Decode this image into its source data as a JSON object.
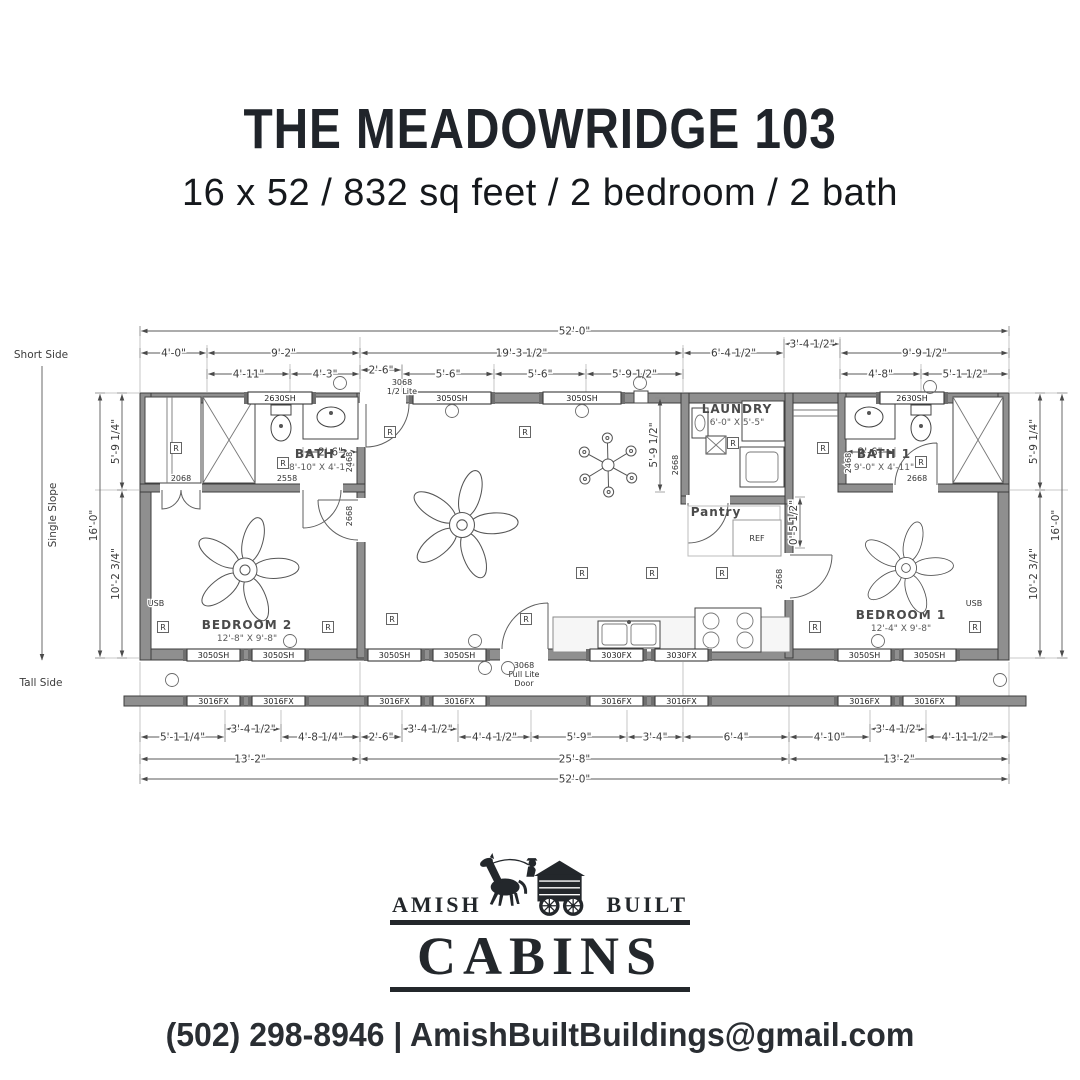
{
  "header": {
    "title": "THE MEADOWRIDGE 103",
    "subtitle": "16 x 52 / 832 sq feet / 2 bedroom / 2 bath"
  },
  "colors": {
    "ink": "#23272b",
    "plan_line": "#4a4a4a",
    "wall_fill": "#8f8f8f"
  },
  "plan": {
    "side": {
      "short": "Short Side",
      "slope": "Single Slope",
      "tall": "Tall Side"
    },
    "receptacle_letter": "R",
    "rooms": [
      {
        "name": "BATH 2",
        "size": "8'-10\" X 4'-11\"",
        "x": 322,
        "y": 458
      },
      {
        "name": "LAUNDRY",
        "size": "6'-0\" X 5'-5\"",
        "x": 737,
        "y": 413
      },
      {
        "name": "BATH 1",
        "size": "9'-0\" X 4'-11\"",
        "x": 884,
        "y": 458
      },
      {
        "name": "Pantry",
        "size": "",
        "x": 716,
        "y": 516
      },
      {
        "name": "BEDROOM 2",
        "size": "12'-8\" X 9'-8\"",
        "x": 247,
        "y": 629
      },
      {
        "name": "BEDROOM 1",
        "size": "12'-4\" X 9'-8\"",
        "x": 901,
        "y": 619
      }
    ],
    "dims_h": [
      {
        "t": "52'-0\"",
        "x1": 140,
        "x2": 1009,
        "y": 331
      },
      {
        "t": "4'-0\"",
        "x1": 140,
        "x2": 207,
        "y": 353
      },
      {
        "t": "9'-2\"",
        "x1": 207,
        "x2": 360,
        "y": 353
      },
      {
        "t": "19'-3 1/2\"",
        "x1": 360,
        "x2": 683,
        "y": 353
      },
      {
        "t": "6'-4 1/2\"",
        "x1": 683,
        "x2": 784,
        "y": 353
      },
      {
        "t": "3'-4 1/2\"",
        "x1": 784,
        "x2": 840,
        "y": 344
      },
      {
        "t": "9'-9 1/2\"",
        "x1": 840,
        "x2": 1009,
        "y": 353
      },
      {
        "t": "4'-11\"",
        "x1": 207,
        "x2": 290,
        "y": 374
      },
      {
        "t": "4'-3\"",
        "x1": 290,
        "x2": 360,
        "y": 374
      },
      {
        "t": "2'-6\"",
        "x1": 360,
        "x2": 402,
        "y": 370
      },
      {
        "t": "5'-6\"",
        "x1": 402,
        "x2": 494,
        "y": 374
      },
      {
        "t": "5'-6\"",
        "x1": 494,
        "x2": 586,
        "y": 374
      },
      {
        "t": "5'-9 1/2\"",
        "x1": 586,
        "x2": 683,
        "y": 374
      },
      {
        "t": "4'-8\"",
        "x1": 840,
        "x2": 921,
        "y": 374
      },
      {
        "t": "5'-1 1/2\"",
        "x1": 921,
        "x2": 1009,
        "y": 374
      },
      {
        "t": "2'-6\"",
        "x1": 303,
        "x2": 358,
        "y": 452
      },
      {
        "t": "2'-6\"",
        "x1": 845,
        "x2": 895,
        "y": 452
      },
      {
        "t": "5'-1 1/4\"",
        "x1": 140,
        "x2": 225,
        "y": 737
      },
      {
        "t": "3'-4 1/2\"",
        "x1": 225,
        "x2": 281,
        "y": 729
      },
      {
        "t": "4'-8 1/4\"",
        "x1": 281,
        "x2": 360,
        "y": 737
      },
      {
        "t": "2'-6\"",
        "x1": 360,
        "x2": 402,
        "y": 737
      },
      {
        "t": "3'-4 1/2\"",
        "x1": 402,
        "x2": 458,
        "y": 729
      },
      {
        "t": "4'-4 1/2\"",
        "x1": 458,
        "x2": 531,
        "y": 737
      },
      {
        "t": "5'-9\"",
        "x1": 531,
        "x2": 627,
        "y": 737
      },
      {
        "t": "3'-4\"",
        "x1": 627,
        "x2": 683,
        "y": 737
      },
      {
        "t": "6'-4\"",
        "x1": 683,
        "x2": 789,
        "y": 737
      },
      {
        "t": "4'-10\"",
        "x1": 789,
        "x2": 870,
        "y": 737
      },
      {
        "t": "3'-4 1/2\"",
        "x1": 870,
        "x2": 926,
        "y": 729
      },
      {
        "t": "4'-11 1/2\"",
        "x1": 926,
        "x2": 1009,
        "y": 737
      },
      {
        "t": "13'-2\"",
        "x1": 140,
        "x2": 360,
        "y": 759
      },
      {
        "t": "25'-8\"",
        "x1": 360,
        "x2": 789,
        "y": 759
      },
      {
        "t": "13'-2\"",
        "x1": 789,
        "x2": 1009,
        "y": 759
      },
      {
        "t": "52'-0\"",
        "x1": 140,
        "x2": 1009,
        "y": 779
      }
    ],
    "dims_v": [
      {
        "t": "16'-0\"",
        "x": 100,
        "y1": 393,
        "y2": 658
      },
      {
        "t": "5'-9 1/4\"",
        "x": 122,
        "y1": 393,
        "y2": 490
      },
      {
        "t": "10'-2 3/4\"",
        "x": 122,
        "y1": 490,
        "y2": 658
      },
      {
        "t": "5'-9 1/4\"",
        "x": 1040,
        "y1": 393,
        "y2": 490
      },
      {
        "t": "10'-2 3/4\"",
        "x": 1040,
        "y1": 490,
        "y2": 658
      },
      {
        "t": "16'-0\"",
        "x": 1062,
        "y1": 393,
        "y2": 658
      },
      {
        "t": "5'-9 1/2\"",
        "x": 660,
        "y1": 398,
        "y2": 492
      },
      {
        "t": "0'-5 1/2\"",
        "x": 800,
        "y1": 497,
        "y2": 548
      }
    ],
    "windows": [
      {
        "t": "2630SH",
        "x": 248,
        "y": 392,
        "w": 64,
        "h": 12
      },
      {
        "t": "3050SH",
        "x": 413,
        "y": 392,
        "w": 78,
        "h": 12
      },
      {
        "t": "3050SH",
        "x": 543,
        "y": 392,
        "w": 78,
        "h": 12
      },
      {
        "t": "2630SH",
        "x": 880,
        "y": 392,
        "w": 64,
        "h": 12
      },
      {
        "t": "3050SH",
        "x": 187,
        "y": 649,
        "w": 53,
        "h": 12
      },
      {
        "t": "3050SH",
        "x": 252,
        "y": 649,
        "w": 53,
        "h": 12
      },
      {
        "t": "3050SH",
        "x": 368,
        "y": 649,
        "w": 53,
        "h": 12
      },
      {
        "t": "3050SH",
        "x": 433,
        "y": 649,
        "w": 53,
        "h": 12
      },
      {
        "t": "3030FX",
        "x": 590,
        "y": 649,
        "w": 53,
        "h": 12
      },
      {
        "t": "3030FX",
        "x": 655,
        "y": 649,
        "w": 53,
        "h": 12
      },
      {
        "t": "3050SH",
        "x": 838,
        "y": 649,
        "w": 53,
        "h": 12
      },
      {
        "t": "3050SH",
        "x": 903,
        "y": 649,
        "w": 53,
        "h": 12
      },
      {
        "t": "3016FX",
        "x": 187,
        "y": 696,
        "w": 53,
        "h": 10
      },
      {
        "t": "3016FX",
        "x": 252,
        "y": 696,
        "w": 53,
        "h": 10
      },
      {
        "t": "3016FX",
        "x": 368,
        "y": 696,
        "w": 53,
        "h": 10
      },
      {
        "t": "3016FX",
        "x": 433,
        "y": 696,
        "w": 53,
        "h": 10
      },
      {
        "t": "3016FX",
        "x": 590,
        "y": 696,
        "w": 53,
        "h": 10
      },
      {
        "t": "3016FX",
        "x": 655,
        "y": 696,
        "w": 53,
        "h": 10
      },
      {
        "t": "3016FX",
        "x": 838,
        "y": 696,
        "w": 53,
        "h": 10
      },
      {
        "t": "3016FX",
        "x": 903,
        "y": 696,
        "w": 53,
        "h": 10
      }
    ],
    "labels": [
      {
        "t": "3068",
        "x": 402,
        "y": 385
      },
      {
        "t": "1/2 Lite",
        "x": 402,
        "y": 394
      },
      {
        "t": "3068",
        "x": 524,
        "y": 668
      },
      {
        "t": "Full Lite",
        "x": 524,
        "y": 677
      },
      {
        "t": "Door",
        "x": 524,
        "y": 686
      },
      {
        "t": "2468",
        "x": 352,
        "y": 462,
        "r": -90
      },
      {
        "t": "2668",
        "x": 352,
        "y": 516,
        "r": -90
      },
      {
        "t": "2068",
        "x": 181,
        "y": 481
      },
      {
        "t": "2558",
        "x": 287,
        "y": 481
      },
      {
        "t": "2668",
        "x": 678,
        "y": 465,
        "r": -90
      },
      {
        "t": "2468",
        "x": 851,
        "y": 463,
        "r": -90
      },
      {
        "t": "2668",
        "x": 917,
        "y": 481
      },
      {
        "t": "2668",
        "x": 782,
        "y": 579,
        "r": -90
      },
      {
        "t": "REF",
        "x": 757,
        "y": 541
      },
      {
        "t": "USB",
        "x": 156,
        "y": 606
      },
      {
        "t": "USB",
        "x": 974,
        "y": 606
      }
    ],
    "receptacles": [
      [
        176,
        448
      ],
      [
        283,
        463
      ],
      [
        390,
        432
      ],
      [
        525,
        432
      ],
      [
        733,
        443
      ],
      [
        823,
        448
      ],
      [
        921,
        462
      ],
      [
        163,
        627
      ],
      [
        328,
        627
      ],
      [
        392,
        619
      ],
      [
        526,
        619
      ],
      [
        582,
        573
      ],
      [
        652,
        573
      ],
      [
        722,
        573
      ],
      [
        815,
        627
      ],
      [
        975,
        627
      ]
    ],
    "lights": [
      [
        340,
        383
      ],
      [
        452,
        411
      ],
      [
        582,
        411
      ],
      [
        640,
        383
      ],
      [
        930,
        387
      ],
      [
        290,
        641
      ],
      [
        475,
        641
      ],
      [
        878,
        641
      ],
      [
        172,
        680
      ],
      [
        485,
        668
      ],
      [
        508,
        668
      ],
      [
        1000,
        680
      ]
    ],
    "fans": [
      {
        "x": 245,
        "y": 570,
        "s": 1
      },
      {
        "x": 462,
        "y": 525,
        "s": 1.04
      },
      {
        "x": 906,
        "y": 568,
        "s": 0.88
      }
    ],
    "chandelier": {
      "x": 608,
      "y": 465
    }
  },
  "logo": {
    "left_word": "AMISH",
    "right_word": "BUILT",
    "main_word": "CABINS"
  },
  "footer": {
    "contact": "(502) 298-8946 | AmishBuiltBuildings@gmail.com"
  }
}
